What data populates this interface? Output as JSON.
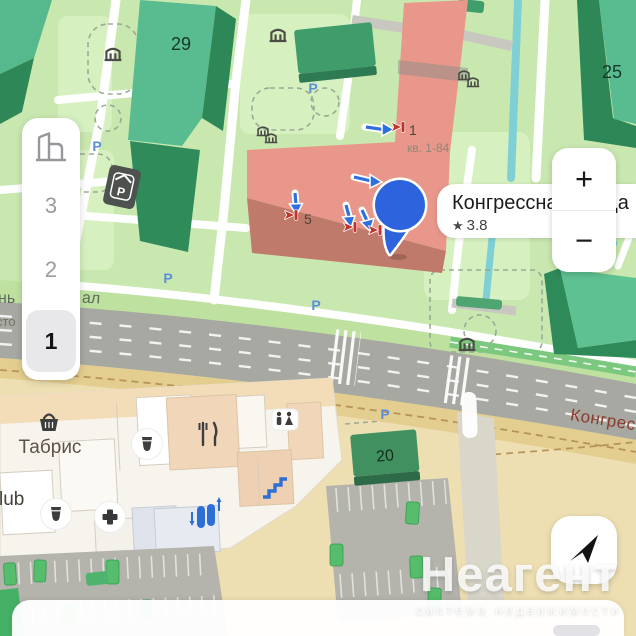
{
  "map": {
    "buildings": {
      "b29": "29",
      "b25": "25",
      "b20": "20"
    },
    "streets": {
      "kongressnaya": "Конгрес",
      "fragment_left_top": "нь",
      "fragment_left_bottom": "сто",
      "fragment_canal": "ал"
    },
    "parking_letter": "P",
    "entrance_1": {
      "number": "1",
      "apartments": "кв. 1-84"
    },
    "entrance_5": {
      "number": "5"
    },
    "mall": {
      "tabris": "Табрис",
      "club_fragment": "lub"
    }
  },
  "callout": {
    "title": "Конгрессная улица",
    "star": "★",
    "rating": "3.8"
  },
  "zoom_control": {
    "zoom_in": "+",
    "zoom_out": "−"
  },
  "floor_selector": {
    "floors": [
      "3",
      "2",
      "1"
    ]
  },
  "watermark": {
    "brand": "Неагент",
    "tagline": "система недвижимости"
  }
}
